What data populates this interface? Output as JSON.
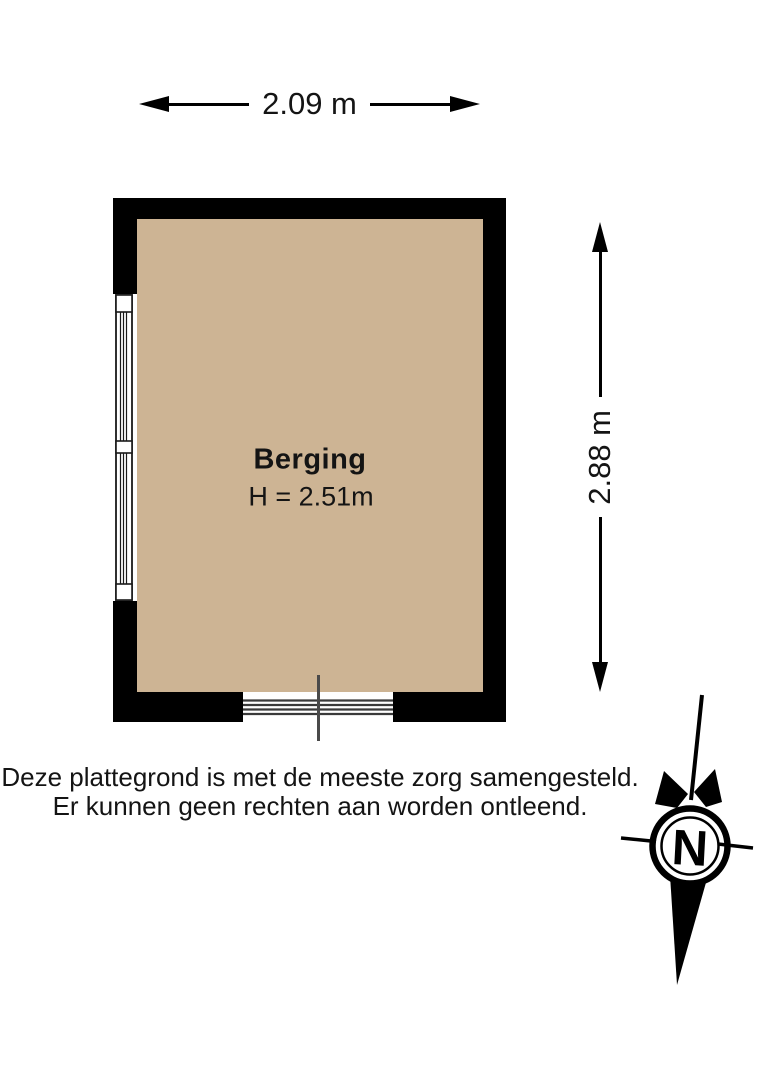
{
  "floorplan": {
    "room": {
      "name": "Berging",
      "height_label": "H = 2.51m"
    },
    "dimensions": {
      "width_label": "2.09 m",
      "depth_label": "2.88 m"
    },
    "disclaimer": {
      "line1": "Deze plattegrond is met de meeste zorg samengesteld.",
      "line2": "Er kunnen geen rechten aan worden ontleend."
    },
    "compass": {
      "north_label": "N"
    },
    "colors": {
      "floor": "#cdb494",
      "wall": "#000000",
      "background": "#ffffff",
      "detail_line": "#3a3a3a"
    }
  }
}
